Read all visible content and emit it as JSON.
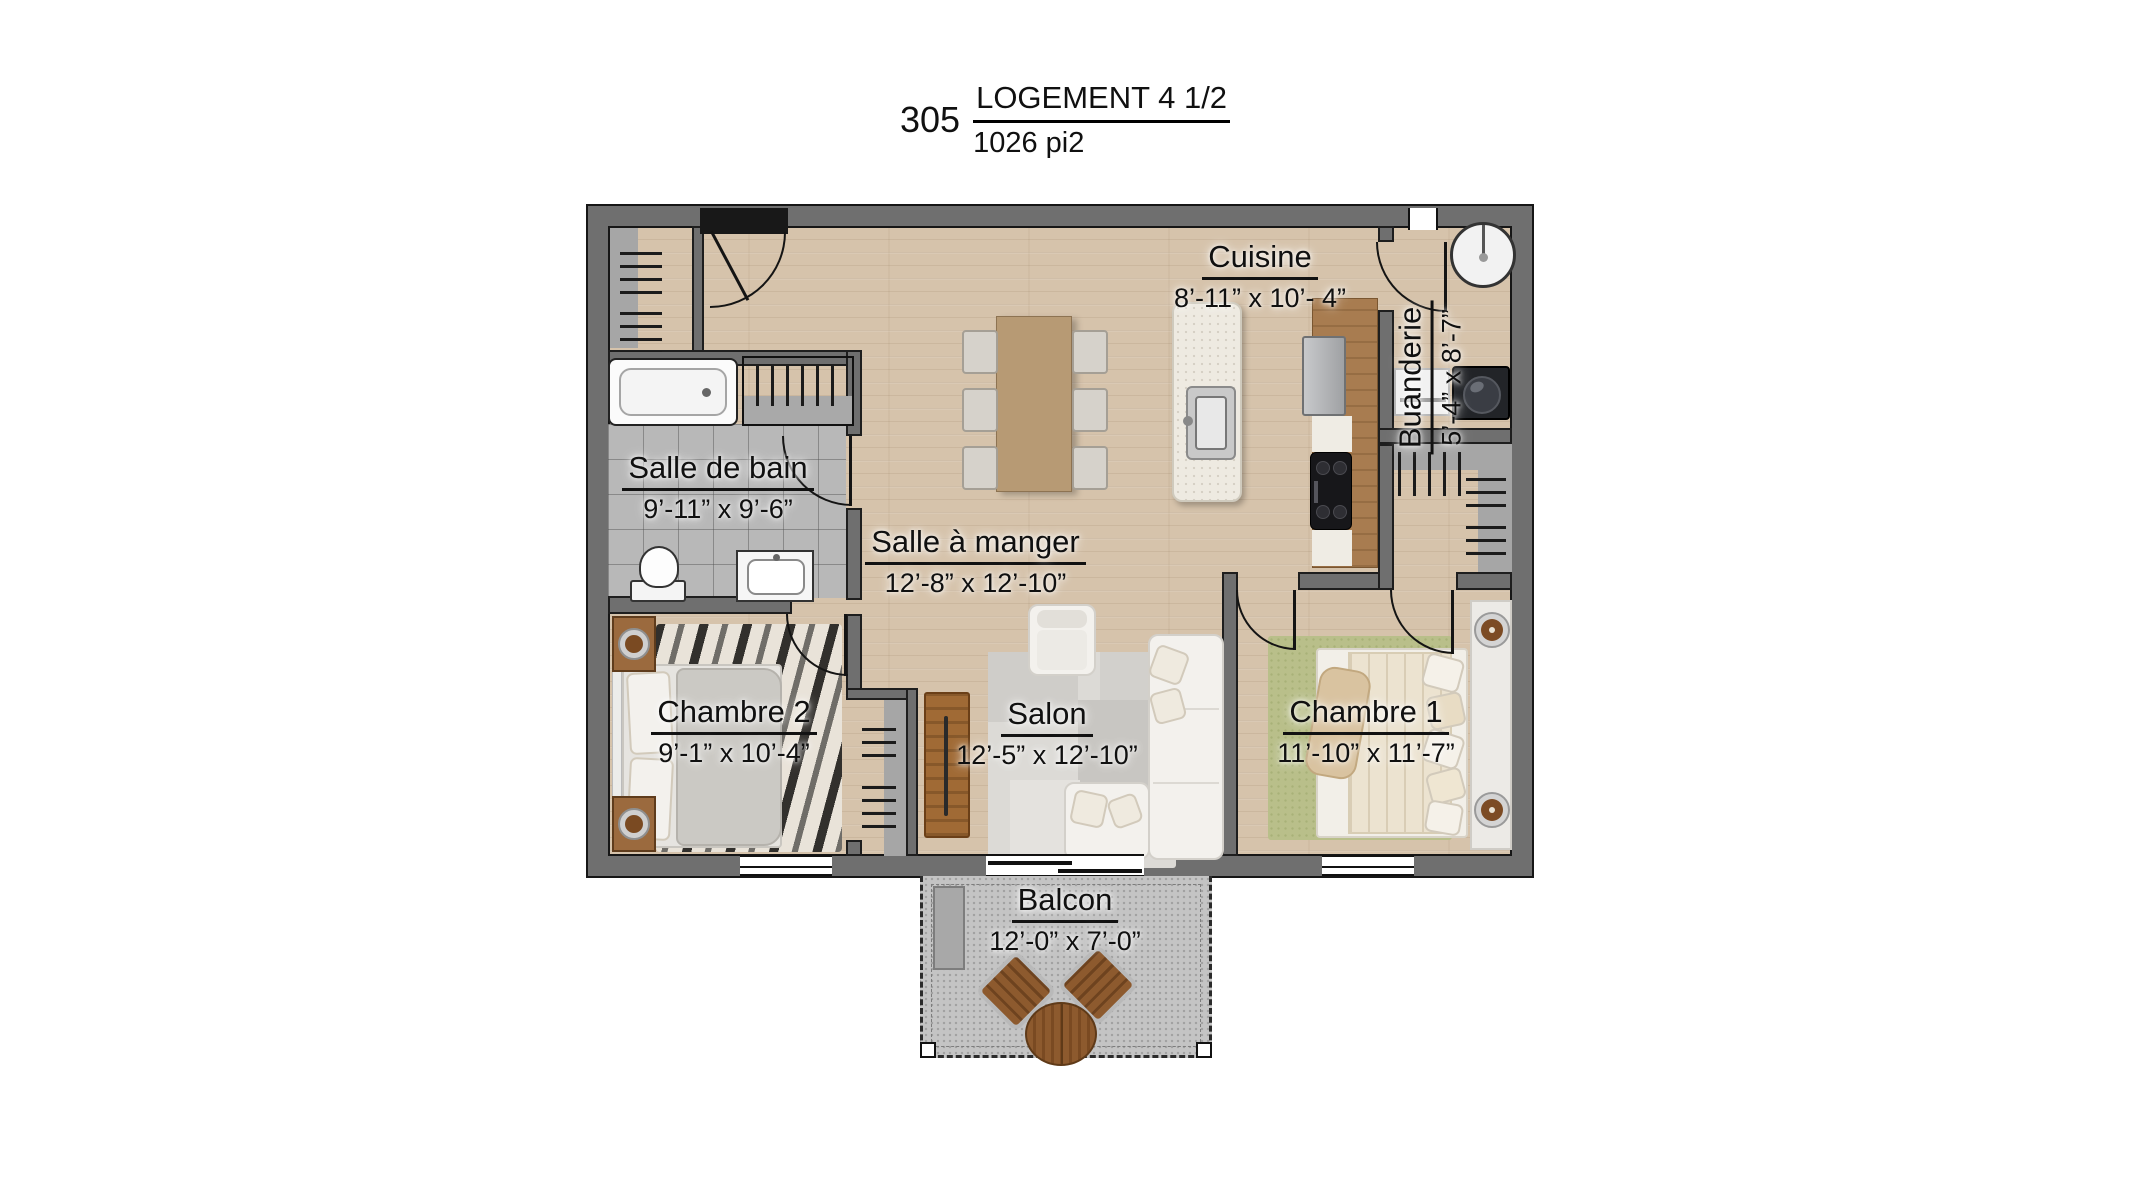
{
  "title": {
    "unit_number": "305",
    "unit_type": "LOGEMENT 4 1/2",
    "area": "1026 pi2"
  },
  "rooms": {
    "cuisine": {
      "name": "Cuisine",
      "dimensions": "8’-11” x 10’- 4”"
    },
    "buanderie": {
      "name": "Buanderie",
      "dimensions": "5’-4” x 8’-7”"
    },
    "salle_de_bain": {
      "name": "Salle de bain",
      "dimensions": "9’-11” x 9’-6”"
    },
    "salle_a_manger": {
      "name": "Salle à manger",
      "dimensions": "12’-8” x 12’-10”"
    },
    "chambre_2": {
      "name": "Chambre 2",
      "dimensions": "9’-1” x 10’-4”"
    },
    "salon": {
      "name": "Salon",
      "dimensions": "12’-5” x 12’-10”"
    },
    "chambre_1": {
      "name": "Chambre 1",
      "dimensions": "11’-10” x 11’-7”"
    },
    "balcon": {
      "name": "Balcon",
      "dimensions": "12’-0” x 7’-0”"
    }
  },
  "colors": {
    "wall": "#6f6f6f",
    "wood_floor": "#d6c3ab",
    "tile_floor": "#b8b8b8",
    "concrete": "#c4c4c4",
    "text": "#101010",
    "rug_green": "#b9bf8a",
    "counter_wood": "#a87c50"
  }
}
